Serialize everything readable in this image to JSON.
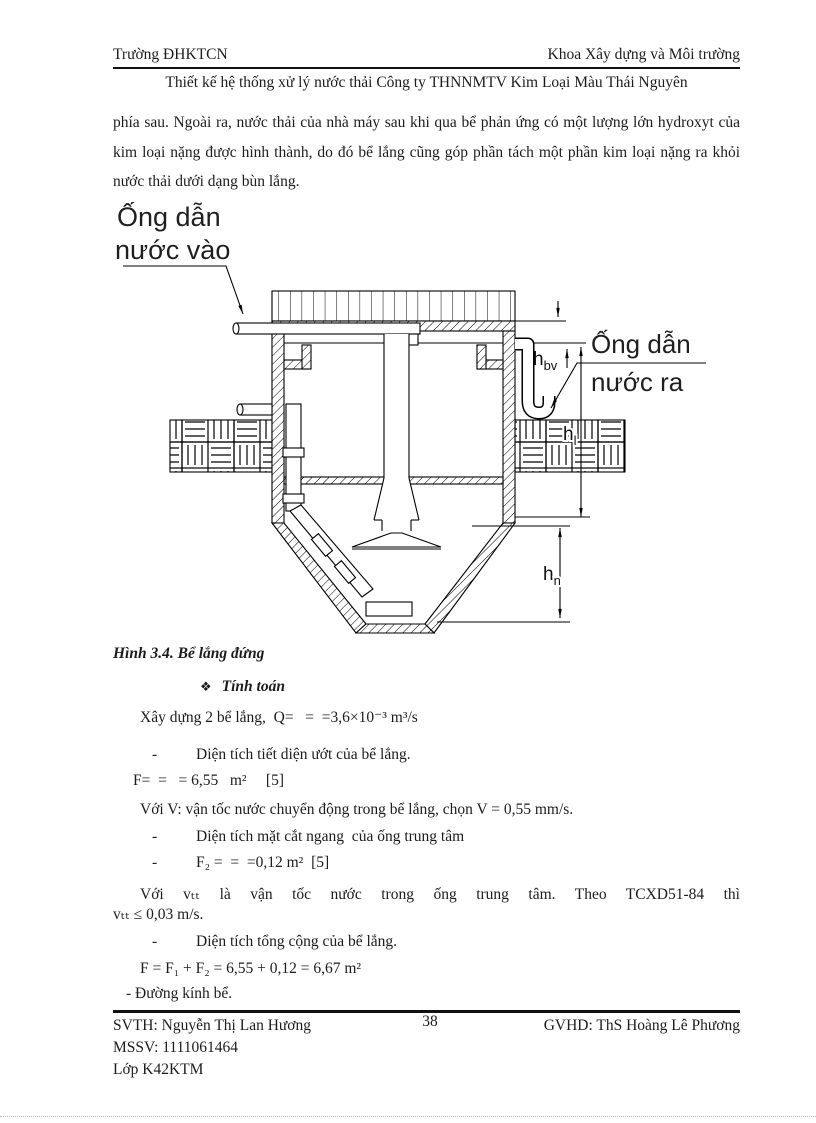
{
  "header": {
    "left": "Trường ĐHKTCN",
    "right": "Khoa Xây dựng và Môi trường",
    "subtitle": "Thiết kế hệ thống xử lý nước thải Công ty THNNMTV  Kim Loại Màu Thái Nguyên"
  },
  "intro_paragraph": "phía sau. Ngoài ra, nước thải của nhà máy sau khi qua bể phản ứng có một lượng lớn hydroxyt của kim loại nặng được hình thành, do đó bể lắng cũng góp phần tách một phần kim loại nặng ra khỏi nước thải dưới dạng bùn lắng.",
  "diagram": {
    "inlet_label": {
      "line1": "Ống dẫn",
      "line2": "nước vào"
    },
    "outlet_label": {
      "line1": "Ống dẫn",
      "line2": "nước ra"
    },
    "dim_hbv": {
      "main": "h",
      "sub": "bv"
    },
    "dim_hl": {
      "main": "h",
      "sub": "l"
    },
    "dim_hn": {
      "main": "h",
      "sub": "n"
    }
  },
  "figure_caption": "Hình  3.4. Bể lắng đứng",
  "calculation": {
    "bullet": "❖",
    "heading": "Tính toán",
    "lines": [
      {
        "text": "Xây dựng 2 bể lắng,  Q=   =  =3,6×10⁻³ m³/s"
      },
      {
        "dash": "-",
        "text": "Diện tích tiết diện ướt của bể lắng."
      },
      {
        "text": "F=  =   = 6,55   m²     [5]"
      },
      {
        "text": "Với V: vận tốc nước chuyển động trong bể lắng, chọn V = 0,55 mm/s."
      },
      {
        "dash": "-",
        "text": "Diện tích mặt cắt ngang  của ống trung tâm"
      },
      {
        "dash": "-",
        "text": "F₂ =  =  =0,12 m²  [5]"
      },
      {
        "text": "Với vₜₜ là vận tốc nước trong ống trung tâm. Theo TCXD51-84 thì"
      },
      {
        "text": "vₜₜ ≤ 0,03 m/s."
      },
      {
        "dash": "-",
        "text": "Diện tích tổng cộng của bể lắng."
      },
      {
        "text": "F = F₁ + F₂ = 6,55 + 0,12 = 6,67 m²"
      },
      {
        "text": "- Đường kính bể."
      }
    ]
  },
  "footer": {
    "svth": "SVTH:  Nguyễn Thị Lan Hương",
    "page_number": "38",
    "gvhd": "GVHD: ThS Hoàng Lê Phương",
    "mssv": "MSSV:  1111061464",
    "lop": "Lớp K42KTM"
  }
}
